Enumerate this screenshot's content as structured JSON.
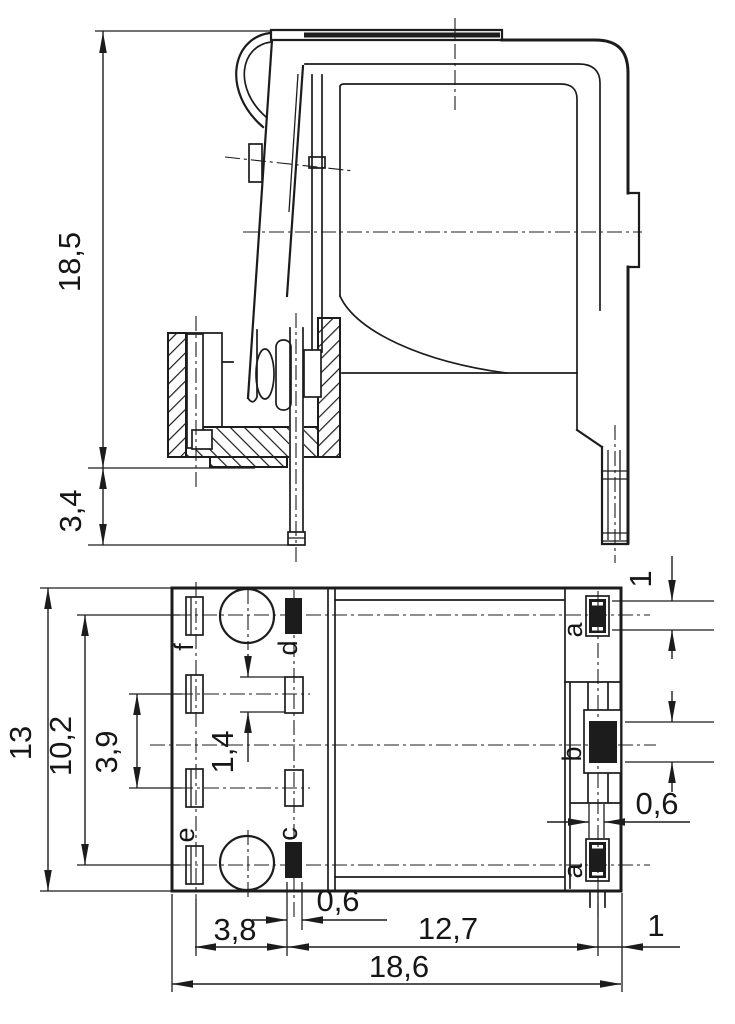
{
  "page": {
    "background_color": "#ffffff",
    "line_color": "#1c1c1c"
  },
  "dimensions": {
    "side_height_total": "18,5",
    "side_pin_length": "3,4",
    "bottom_height_total": "13",
    "bottom_row_span_outer": "10,2",
    "bottom_row_span_inner": "3,9",
    "bottom_slot_length": "1,4",
    "right_pin_a_length": "1",
    "right_pin_width": "0,6",
    "bottom_pin_c_width": "0,6",
    "bottom_offset_left": "3,8",
    "bottom_pin_pitch": "12,7",
    "bottom_offset_right": "1",
    "bottom_width_total": "18,6"
  },
  "pin_labels": {
    "a_top": "a",
    "b": "b",
    "a_bottom": "a",
    "c": "c",
    "d": "d",
    "e": "e",
    "f": "f"
  }
}
